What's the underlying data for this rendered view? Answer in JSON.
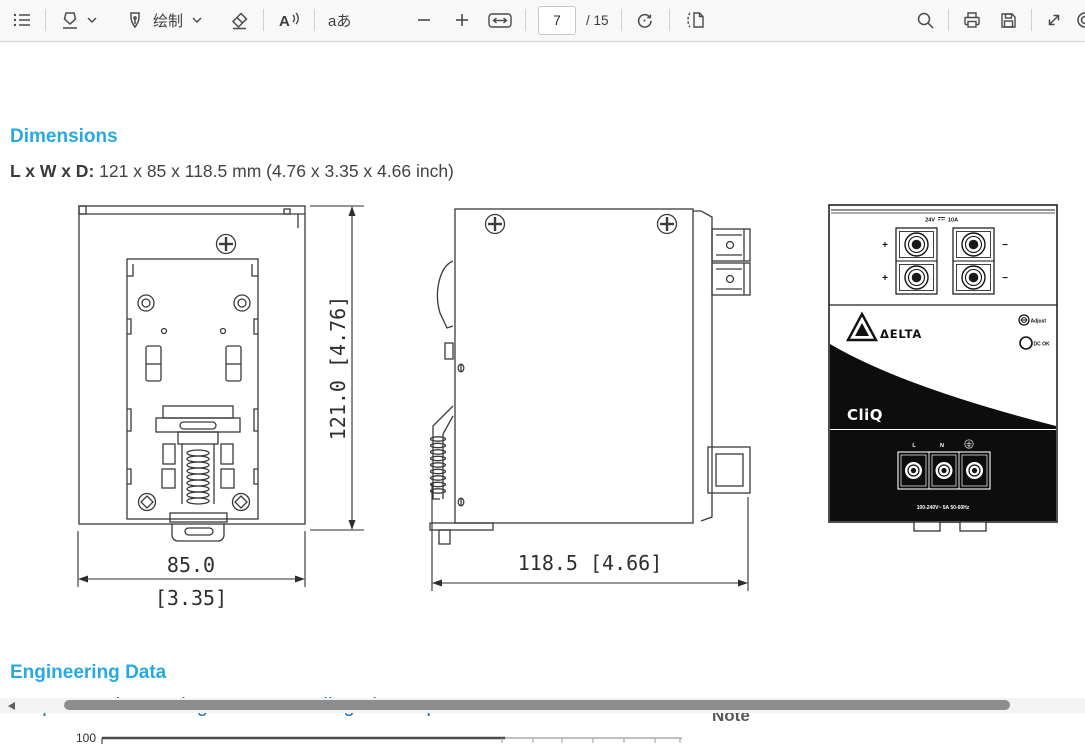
{
  "toolbar": {
    "draw_label": "绘制",
    "read_aloud_glyph": "A",
    "translate_glyph": "aあ",
    "page_current": "7",
    "page_total": "/ 15"
  },
  "document": {
    "dimensions_title": "Dimensions",
    "lwd_label": "L x W x D:",
    "lwd_value": " 121 x 85 x 118.5 mm (4.76 x 3.35 x 4.66 inch)",
    "engineering_title": "Engineering Data",
    "derating_heading": "Output Load De-rating VS Surrounding Air Temperature",
    "note_label": "Note",
    "chart_top_tick": "100"
  },
  "drawings": {
    "back_view": {
      "height_label": "121.0  [4.76]",
      "width_mm": "85.0",
      "width_inch": "[3.35]"
    },
    "side_view": {
      "depth_label": "118.5  [4.66]"
    },
    "front_panel": {
      "output_voltage": "24V",
      "output_current": "10A",
      "plus": "+",
      "minus": "−",
      "brand": "ΔELTA",
      "adjust_label": "Adjust",
      "dc_ok_label": "DC OK",
      "series_logo": "CliQ",
      "line_label": "L",
      "neutral_label": "N",
      "input_rating": "100-240V~ 5A 50-60Hz"
    }
  },
  "colors": {
    "accent_cyan": "#29A9E1",
    "heading_blue": "#1B74B8"
  }
}
